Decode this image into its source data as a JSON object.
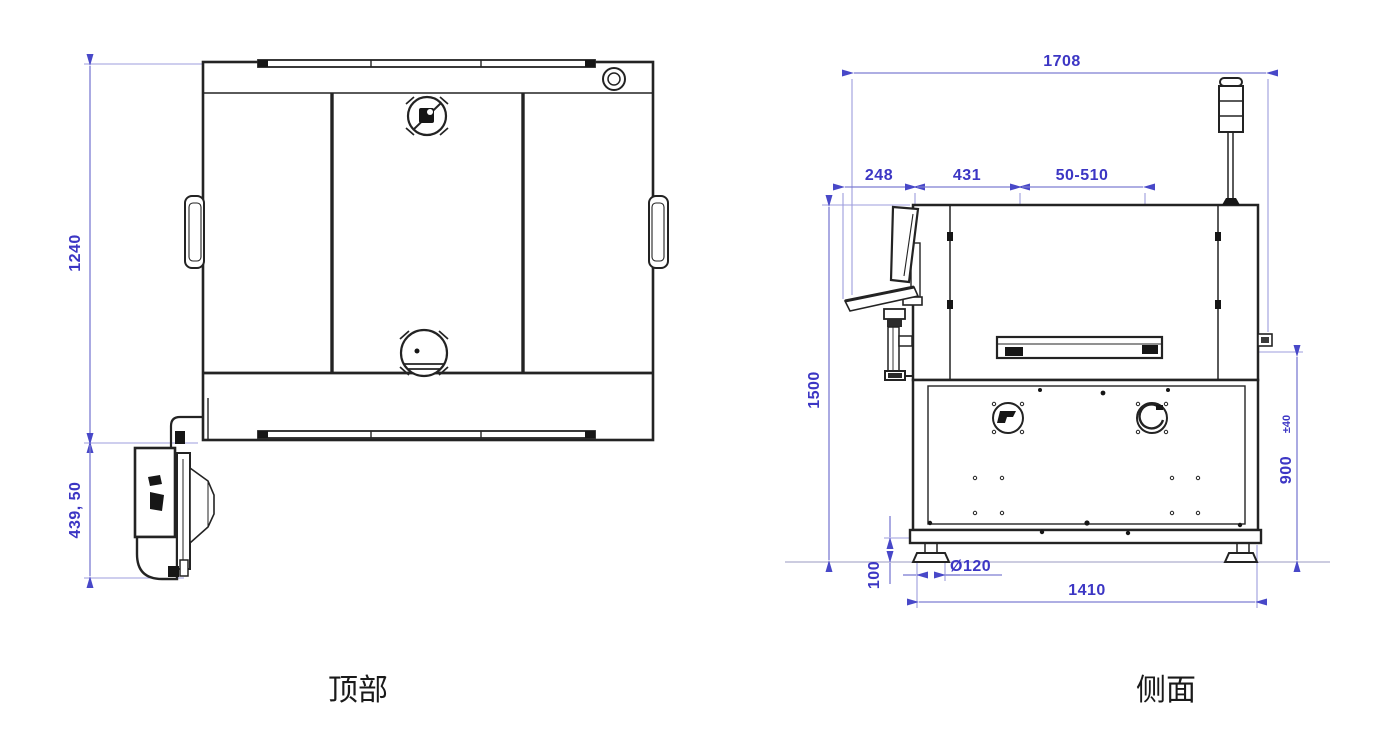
{
  "drawing": {
    "background": "#ffffff",
    "colors": {
      "outline": "#232323",
      "dim_line": "#7d7dd2",
      "extension_line": "#9d9ddd",
      "dim_arrow": "#4848c8",
      "dim_text": "#3c36c4",
      "caption_text": "#1a1a1a"
    },
    "views": {
      "top": {
        "caption": "顶部",
        "dims": {
          "body_height": "1240",
          "monitor_offset": "439, 50"
        }
      },
      "side": {
        "caption": "侧面",
        "dims": {
          "overall_width": "1708",
          "monitor_overhang": "248",
          "front_to_rail": "431",
          "rail_travel": "50-510",
          "overall_height": "1500",
          "rail_height": "900",
          "rail_height_tolerance": "±40",
          "foot_clearance": "100",
          "foot_diameter": "Ø120",
          "base_width": "1410"
        }
      }
    }
  }
}
